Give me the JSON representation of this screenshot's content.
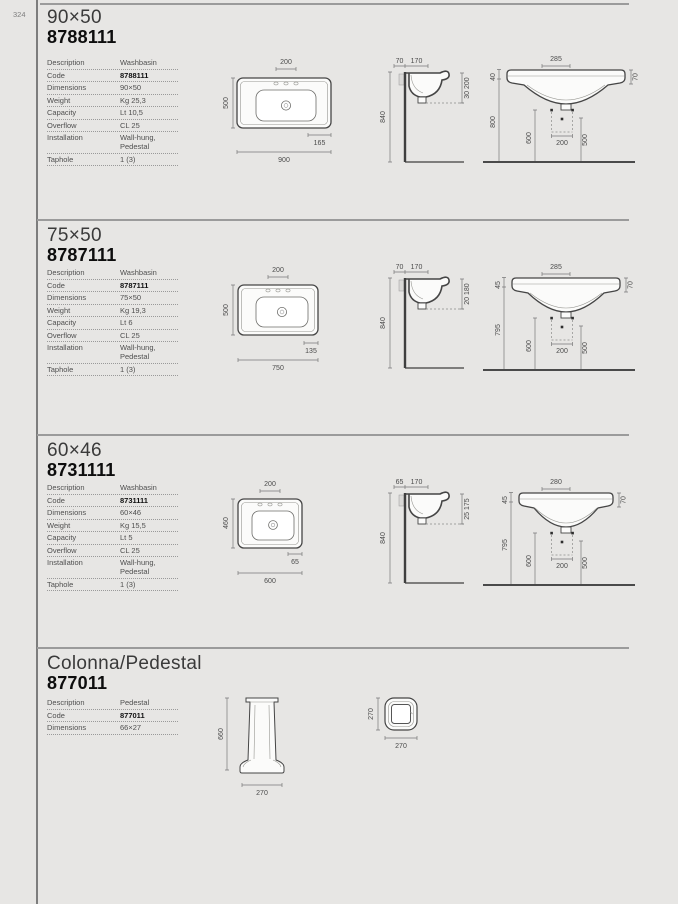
{
  "page": {
    "number": "324"
  },
  "sections": [
    {
      "title": "90×50",
      "code": "8788111",
      "specs": {
        "rows": [
          {
            "label": "Description",
            "value": "Washbasin"
          },
          {
            "label": "Code",
            "value": "8788111"
          },
          {
            "label": "Dimensions",
            "value": "90×50"
          },
          {
            "label": "Weight",
            "value": "Kg 25,3"
          },
          {
            "label": "Capacity",
            "value": "Lt 10,5"
          },
          {
            "label": "Overflow",
            "value": "CL 25"
          },
          {
            "label": "Installation",
            "value": "Wall-hung, Pedestal"
          },
          {
            "label": "Taphole",
            "value": "1 (3)"
          }
        ]
      },
      "plan": {
        "tap": "200",
        "depth": "500",
        "offset": "165",
        "width": "900"
      },
      "side": {
        "d1": "70",
        "d2": "170",
        "height": "840",
        "wall": "30 200"
      },
      "front": {
        "width": "285",
        "rim": "40",
        "edge": "70",
        "height": "800",
        "left": "600",
        "center": "200",
        "right": "500"
      }
    },
    {
      "title": "75×50",
      "code": "8787111",
      "specs": {
        "rows": [
          {
            "label": "Description",
            "value": "Washbasin"
          },
          {
            "label": "Code",
            "value": "8787111"
          },
          {
            "label": "Dimensions",
            "value": "75×50"
          },
          {
            "label": "Weight",
            "value": "Kg 19,3"
          },
          {
            "label": "Capacity",
            "value": "Lt 6"
          },
          {
            "label": "Overflow",
            "value": "CL 25"
          },
          {
            "label": "Installation",
            "value": "Wall-hung, Pedestal"
          },
          {
            "label": "Taphole",
            "value": "1 (3)"
          }
        ]
      },
      "plan": {
        "tap": "200",
        "depth": "500",
        "offset": "135",
        "width": "750"
      },
      "side": {
        "d1": "70",
        "d2": "170",
        "height": "840",
        "wall": "20 180"
      },
      "front": {
        "width": "285",
        "rim": "45",
        "edge": "70",
        "height": "795",
        "left": "600",
        "center": "200",
        "right": "500"
      }
    },
    {
      "title": "60×46",
      "code": "8731111",
      "specs": {
        "rows": [
          {
            "label": "Description",
            "value": "Washbasin"
          },
          {
            "label": "Code",
            "value": "8731111"
          },
          {
            "label": "Dimensions",
            "value": "60×46"
          },
          {
            "label": "Weight",
            "value": "Kg 15,5"
          },
          {
            "label": "Capacity",
            "value": "Lt 5"
          },
          {
            "label": "Overflow",
            "value": "CL 25"
          },
          {
            "label": "Installation",
            "value": "Wall-hung, Pedestal"
          },
          {
            "label": "Taphole",
            "value": "1 (3)"
          }
        ]
      },
      "plan": {
        "tap": "200",
        "depth": "460",
        "offset": "65",
        "width": "600"
      },
      "side": {
        "d1": "65",
        "d2": "170",
        "height": "840",
        "wall": "25 175"
      },
      "front": {
        "width": "280",
        "rim": "45",
        "edge": "70",
        "height": "795",
        "left": "600",
        "center": "200",
        "right": "500"
      }
    },
    {
      "title": "Colonna/Pedestal",
      "code": "877011",
      "specs": {
        "rows": [
          {
            "label": "Description",
            "value": "Pedestal"
          },
          {
            "label": "Code",
            "value": "877011"
          },
          {
            "label": "Dimensions",
            "value": "66×27"
          }
        ]
      },
      "pedestal": {
        "height": "660",
        "width": "270"
      },
      "plan": {
        "side": "270",
        "width": "270"
      }
    }
  ]
}
